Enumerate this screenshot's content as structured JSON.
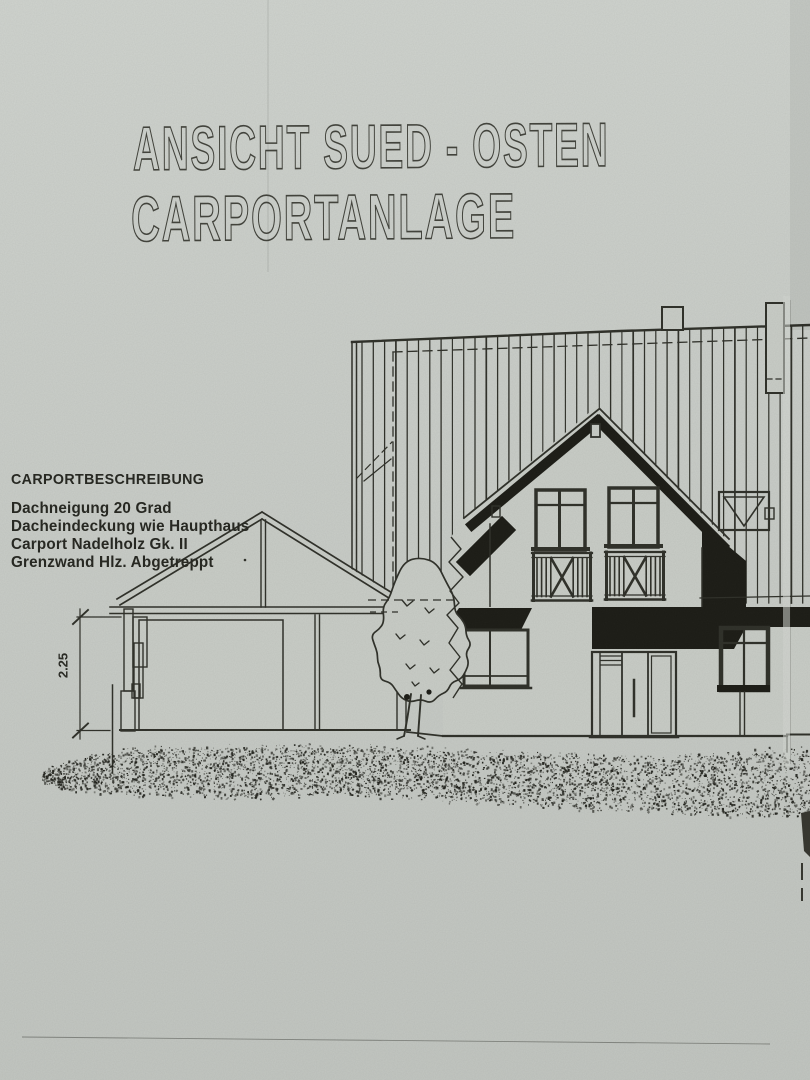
{
  "titles": {
    "line1": "ANSICHT SUED - OSTEN",
    "line2": "CARPORTANLAGE"
  },
  "description": {
    "heading": "CARPORTBESCHREIBUNG",
    "lines": [
      "Dachneigung 20 Grad",
      "Dacheindeckung wie Haupthaus",
      "Carport Nadelholz Gk. II",
      "Grenzwand Hlz. Abgetreppt"
    ]
  },
  "dimension": {
    "label": "2.25"
  },
  "colors": {
    "paper": "#c9cdc7",
    "ink": "#2e2f28",
    "ink_dark": "#1b1b15",
    "title_outline": "#42433c"
  }
}
